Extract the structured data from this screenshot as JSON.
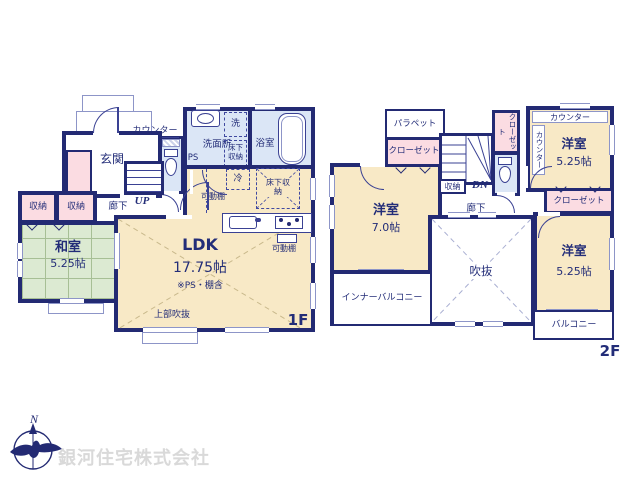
{
  "f1": {
    "floor": "1F",
    "genkan": "玄関",
    "counter": "カウンター",
    "senmenjo": "洗面所",
    "ps": "PS",
    "washer": "洗",
    "yukashita_wet": "床下収納",
    "bath": "浴室",
    "fridge": "冷",
    "yukashita_kitchen": "床下収納",
    "kadodana_pantry": "可動棚",
    "kadodana_kitchen": "可動棚",
    "rouka": "廊下",
    "up": "UP",
    "shuno1": "収納",
    "shuno2": "収納",
    "washitsu": "和室",
    "washitsu_size": "5.25帖",
    "ldk": "LDK",
    "ldk_size": "17.75帖",
    "ldk_note": "※PS・棚含",
    "joubu_fukinuke": "上部吹抜"
  },
  "f2": {
    "floor": "2F",
    "parapet": "パラペット",
    "closet_nw": "クローゼット",
    "closet_n": "クローゼット",
    "closet_e": "クローゼット",
    "stairs_dn": "DN",
    "shuno": "収納",
    "rouka": "廊下",
    "counter_v": "カウンター",
    "counter_top": "カウンター",
    "west_room": "洋室",
    "west_size": "7.0帖",
    "ne_room": "洋室",
    "ne_size": "5.25帖",
    "se_room": "洋室",
    "se_size": "5.25帖",
    "fukinuke": "吹抜",
    "inner_balcony": "インナーバルコニー",
    "balcony": "バルコニー"
  },
  "footer": {
    "company": "銀河住宅株式会社",
    "north": "N"
  }
}
